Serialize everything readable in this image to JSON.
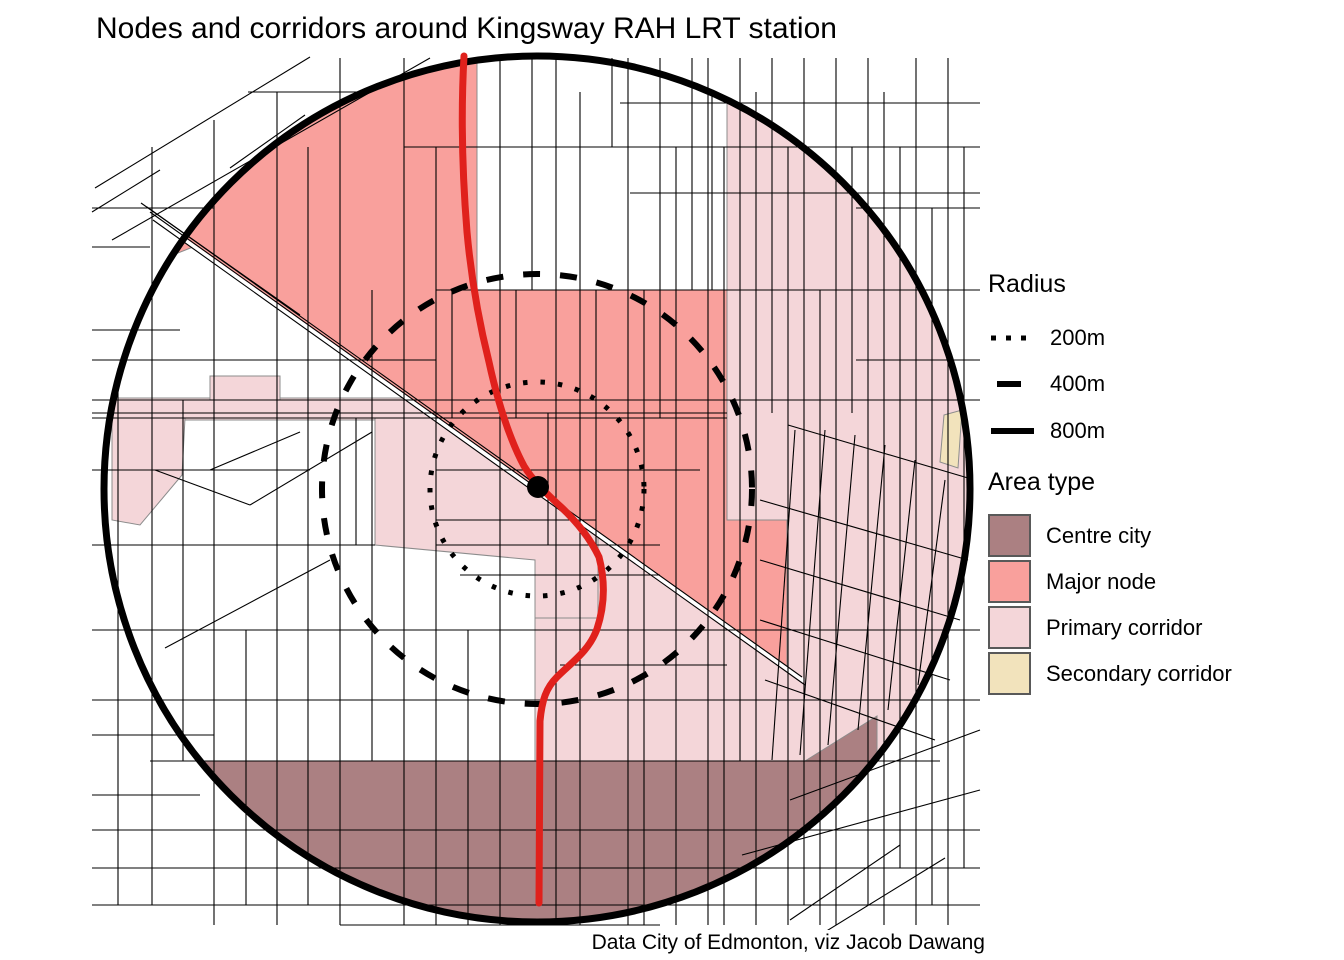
{
  "title": "Nodes and corridors around Kingsway RAH LRT station",
  "caption": "Data City of Edmonton, viz Jacob Dawang",
  "radius_legend": {
    "title": "Radius",
    "items": [
      {
        "label": "200m",
        "style": "dotted"
      },
      {
        "label": "400m",
        "style": "dashed"
      },
      {
        "label": "800m",
        "style": "solid"
      }
    ]
  },
  "area_legend": {
    "title": "Area type",
    "items": [
      {
        "label": "Centre city",
        "color": "#AB8082"
      },
      {
        "label": "Major node",
        "color": "#F9A09C"
      },
      {
        "label": "Primary corridor",
        "color": "#F4D6D9"
      },
      {
        "label": "Secondary corridor",
        "color": "#F2E3BC"
      }
    ]
  },
  "map": {
    "station_name": "Kingsway RAH LRT station",
    "circle_center": {
      "x": 537,
      "y": 489
    },
    "station": {
      "x": 538,
      "y": 487
    },
    "radii_px": {
      "r200": 107,
      "r400": 215,
      "r800": 433
    },
    "radii_m": {
      "r200": 200,
      "r400": 400,
      "r800": 800
    },
    "colors": {
      "lrt_line": "#E0211C",
      "street": "#000000",
      "ring": "#000000",
      "station_dot": "#000000",
      "polygon_border": "#8C8C8C",
      "road_channel": "#FFFFFF"
    }
  },
  "streets": {
    "verticals": [
      [
        118,
        368,
        905
      ],
      [
        152,
        147,
        905
      ],
      [
        183,
        400,
        761
      ],
      [
        214,
        120,
        925
      ],
      [
        246,
        630,
        905
      ],
      [
        277,
        92,
        925
      ],
      [
        308,
        147,
        905
      ],
      [
        340,
        58,
        925
      ],
      [
        356,
        418,
        545
      ],
      [
        372,
        290,
        761
      ],
      [
        404,
        58,
        925
      ],
      [
        436,
        147,
        925
      ],
      [
        452,
        290,
        418
      ],
      [
        468,
        630,
        925
      ],
      [
        500,
        58,
        925
      ],
      [
        516,
        290,
        418
      ],
      [
        532,
        58,
        290
      ],
      [
        548,
        413,
        545
      ],
      [
        556,
        58,
        925
      ],
      [
        580,
        92,
        925
      ],
      [
        596,
        290,
        545
      ],
      [
        612,
        58,
        147
      ],
      [
        628,
        58,
        925
      ],
      [
        644,
        290,
        925
      ],
      [
        660,
        58,
        418
      ],
      [
        676,
        147,
        925
      ],
      [
        692,
        58,
        290
      ],
      [
        708,
        58,
        925
      ],
      [
        712,
        92,
        290
      ],
      [
        724,
        147,
        925
      ],
      [
        740,
        58,
        761
      ],
      [
        756,
        92,
        925
      ],
      [
        772,
        58,
        413
      ],
      [
        788,
        147,
        925
      ],
      [
        804,
        58,
        905
      ],
      [
        820,
        290,
        925
      ],
      [
        836,
        58,
        925
      ],
      [
        852,
        147,
        413
      ],
      [
        868,
        58,
        905
      ],
      [
        884,
        92,
        925
      ],
      [
        900,
        147,
        868
      ],
      [
        916,
        58,
        925
      ],
      [
        932,
        208,
        905
      ],
      [
        948,
        58,
        925
      ],
      [
        964,
        147,
        868
      ]
    ],
    "horizontals": [
      [
        92,
        248,
        372
      ],
      [
        103,
        620,
        980
      ],
      [
        147,
        404,
        980
      ],
      [
        193,
        630,
        980
      ],
      [
        208,
        92,
        214
      ],
      [
        208,
        856,
        980
      ],
      [
        247,
        92,
        150
      ],
      [
        290,
        436,
        980
      ],
      [
        330,
        92,
        180
      ],
      [
        360,
        92,
        436
      ],
      [
        360,
        856,
        980
      ],
      [
        400,
        92,
        980
      ],
      [
        413,
        92,
        727
      ],
      [
        418,
        92,
        727
      ],
      [
        470,
        92,
        310
      ],
      [
        470,
        436,
        700
      ],
      [
        520,
        436,
        596
      ],
      [
        545,
        92,
        375
      ],
      [
        545,
        436,
        660
      ],
      [
        575,
        460,
        660
      ],
      [
        630,
        92,
        980
      ],
      [
        665,
        560,
        727
      ],
      [
        700,
        92,
        980
      ],
      [
        735,
        92,
        214
      ],
      [
        761,
        150,
        940
      ],
      [
        795,
        92,
        200
      ],
      [
        830,
        92,
        980
      ],
      [
        868,
        92,
        980
      ],
      [
        905,
        92,
        980
      ],
      [
        925,
        340,
        660
      ]
    ],
    "diagonals": [
      [
        150,
        212,
        802,
        677
      ],
      [
        153,
        220,
        805,
        685
      ],
      [
        147,
        207,
        530,
        480
      ],
      [
        141,
        203,
        300,
        315
      ],
      [
        95,
        188,
        310,
        57
      ],
      [
        112,
        240,
        430,
        58
      ],
      [
        230,
        168,
        305,
        115
      ],
      [
        92,
        212,
        160,
        170
      ],
      [
        795,
        430,
        772,
        760
      ],
      [
        825,
        430,
        800,
        755
      ],
      [
        855,
        435,
        828,
        745
      ],
      [
        885,
        445,
        858,
        730
      ],
      [
        915,
        460,
        888,
        710
      ],
      [
        945,
        480,
        918,
        685
      ],
      [
        760,
        500,
        968,
        560
      ],
      [
        760,
        560,
        960,
        620
      ],
      [
        760,
        620,
        950,
        680
      ],
      [
        765,
        680,
        935,
        740
      ],
      [
        788,
        425,
        968,
        478
      ],
      [
        790,
        920,
        900,
        845
      ],
      [
        820,
        935,
        945,
        858
      ],
      [
        742,
        855,
        980,
        790
      ],
      [
        790,
        800,
        980,
        730
      ],
      [
        155,
        470,
        250,
        505
      ],
      [
        250,
        505,
        372,
        432
      ],
      [
        165,
        648,
        330,
        560
      ],
      [
        210,
        470,
        300,
        432
      ]
    ]
  }
}
